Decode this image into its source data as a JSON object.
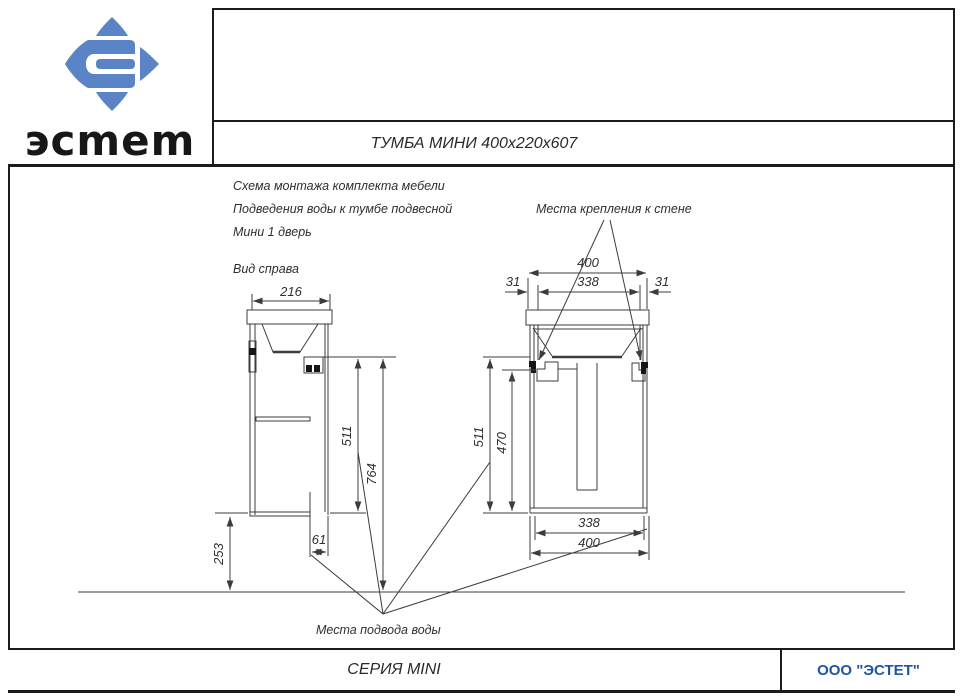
{
  "header": {
    "logo_text": "эсmem",
    "title": "ТУМБА МИНИ  400x220x607"
  },
  "notes": {
    "line1": "Схема монтажа комплекта мебели",
    "line2": "Подведения воды к тумбе подвесной",
    "line3": "Мини 1 дверь",
    "side_view_label": "Вид справа",
    "wall_mount_label": "Места крепления к стене",
    "water_supply_label": "Места подвода воды"
  },
  "dimensions": {
    "side_depth": "216",
    "side_height_bracket": "511",
    "side_height_total": "764",
    "side_water_offset": "61",
    "side_bottom_height": "253",
    "front_width_top": "400",
    "front_bracket_span": "338",
    "front_margin_left": "31",
    "front_margin_right": "31",
    "front_height_bracket": "511",
    "front_height_water": "470",
    "front_bottom_span": "338",
    "front_bottom_width": "400"
  },
  "footer": {
    "series": "СЕРИЯ MINI",
    "company": "ООО \"ЭСТЕТ\""
  },
  "colors": {
    "brand_blue": "#1e56a0",
    "logo_blue": "#5b84c6",
    "line_gray": "#3c3c3c"
  }
}
